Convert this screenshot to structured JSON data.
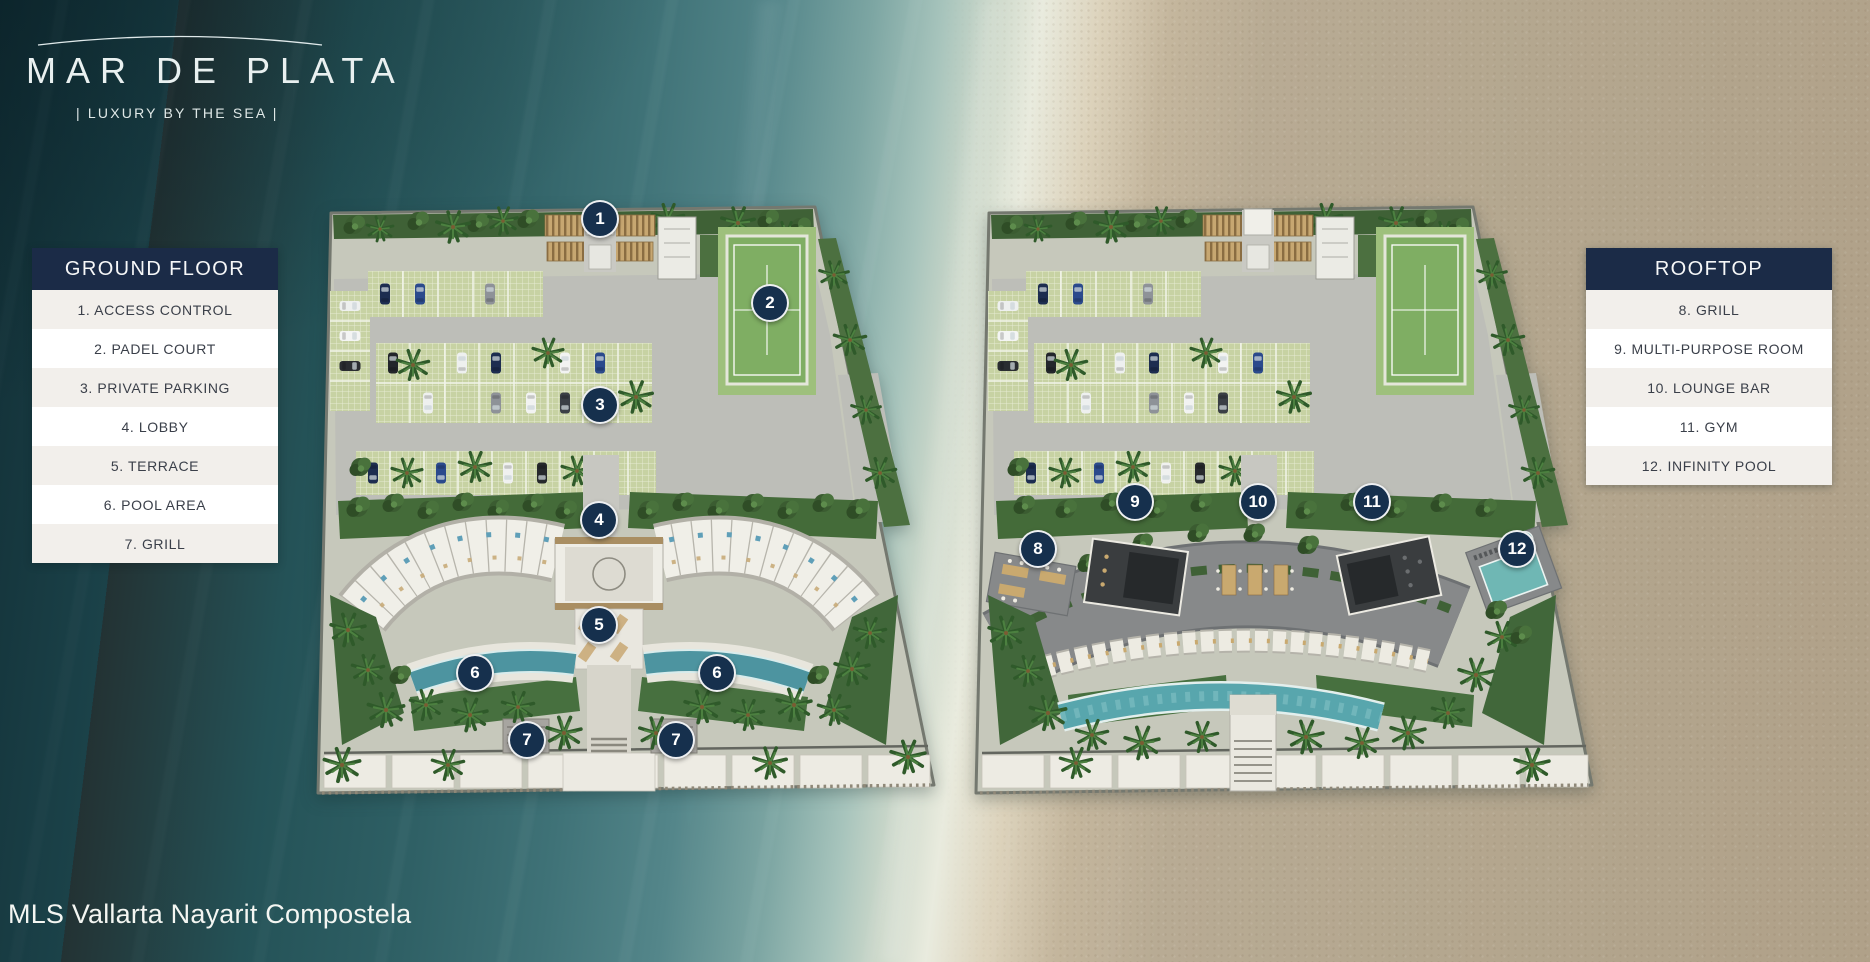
{
  "brand": {
    "name": "MAR DE PLATA",
    "tagline": "| LUXURY BY THE SEA |"
  },
  "footer": {
    "credit": "MLS Vallarta Nayarit Compostela"
  },
  "palette": {
    "legend_header_navy": "#1b2b47",
    "marker_navy": "#16304d",
    "legend_row_alt": "#f2efeb",
    "legend_text": "#3a3f49",
    "ocean_deep": "#1b4249",
    "ocean_mid": "#3f7277",
    "surf_white": "#e9ebde",
    "sand": "#b5a88f",
    "padel_green": "#7fae63",
    "pool_teal": "#4d94a0",
    "rooftop_pool_teal": "#6fb7b4",
    "rooftop_deck_gray": "#87898a"
  },
  "legends": [
    {
      "id": "ground-floor",
      "title": "GROUND FLOOR",
      "items": [
        {
          "number": 1,
          "label": "ACCESS CONTROL"
        },
        {
          "number": 2,
          "label": "PADEL COURT"
        },
        {
          "number": 3,
          "label": "PRIVATE PARKING"
        },
        {
          "number": 4,
          "label": "LOBBY"
        },
        {
          "number": 5,
          "label": "TERRACE"
        },
        {
          "number": 6,
          "label": "POOL AREA"
        },
        {
          "number": 7,
          "label": "GRILL"
        }
      ]
    },
    {
      "id": "rooftop",
      "title": "ROOFTOP",
      "items": [
        {
          "number": 8,
          "label": "GRILL"
        },
        {
          "number": 9,
          "label": "MULTI-PURPOSE ROOM"
        },
        {
          "number": 10,
          "label": "LOUNGE BAR"
        },
        {
          "number": 11,
          "label": "GYM"
        },
        {
          "number": 12,
          "label": "INFINITY POOL"
        }
      ]
    }
  ],
  "plans": [
    {
      "id": "ground-floor-plan",
      "markers": [
        {
          "number": 1,
          "x": 600,
          "y": 219
        },
        {
          "number": 2,
          "x": 770,
          "y": 303
        },
        {
          "number": 3,
          "x": 600,
          "y": 405
        },
        {
          "number": 4,
          "x": 599,
          "y": 520
        },
        {
          "number": 5,
          "x": 599,
          "y": 625
        },
        {
          "number": 6,
          "x": 475,
          "y": 673
        },
        {
          "number": 6,
          "x": 717,
          "y": 673
        },
        {
          "number": 7,
          "x": 527,
          "y": 740
        },
        {
          "number": 7,
          "x": 676,
          "y": 740
        }
      ]
    },
    {
      "id": "rooftop-plan",
      "markers": [
        {
          "number": 8,
          "x": 1038,
          "y": 549
        },
        {
          "number": 9,
          "x": 1135,
          "y": 502
        },
        {
          "number": 10,
          "x": 1258,
          "y": 502
        },
        {
          "number": 11,
          "x": 1372,
          "y": 502
        },
        {
          "number": 12,
          "x": 1517,
          "y": 549
        }
      ]
    }
  ]
}
